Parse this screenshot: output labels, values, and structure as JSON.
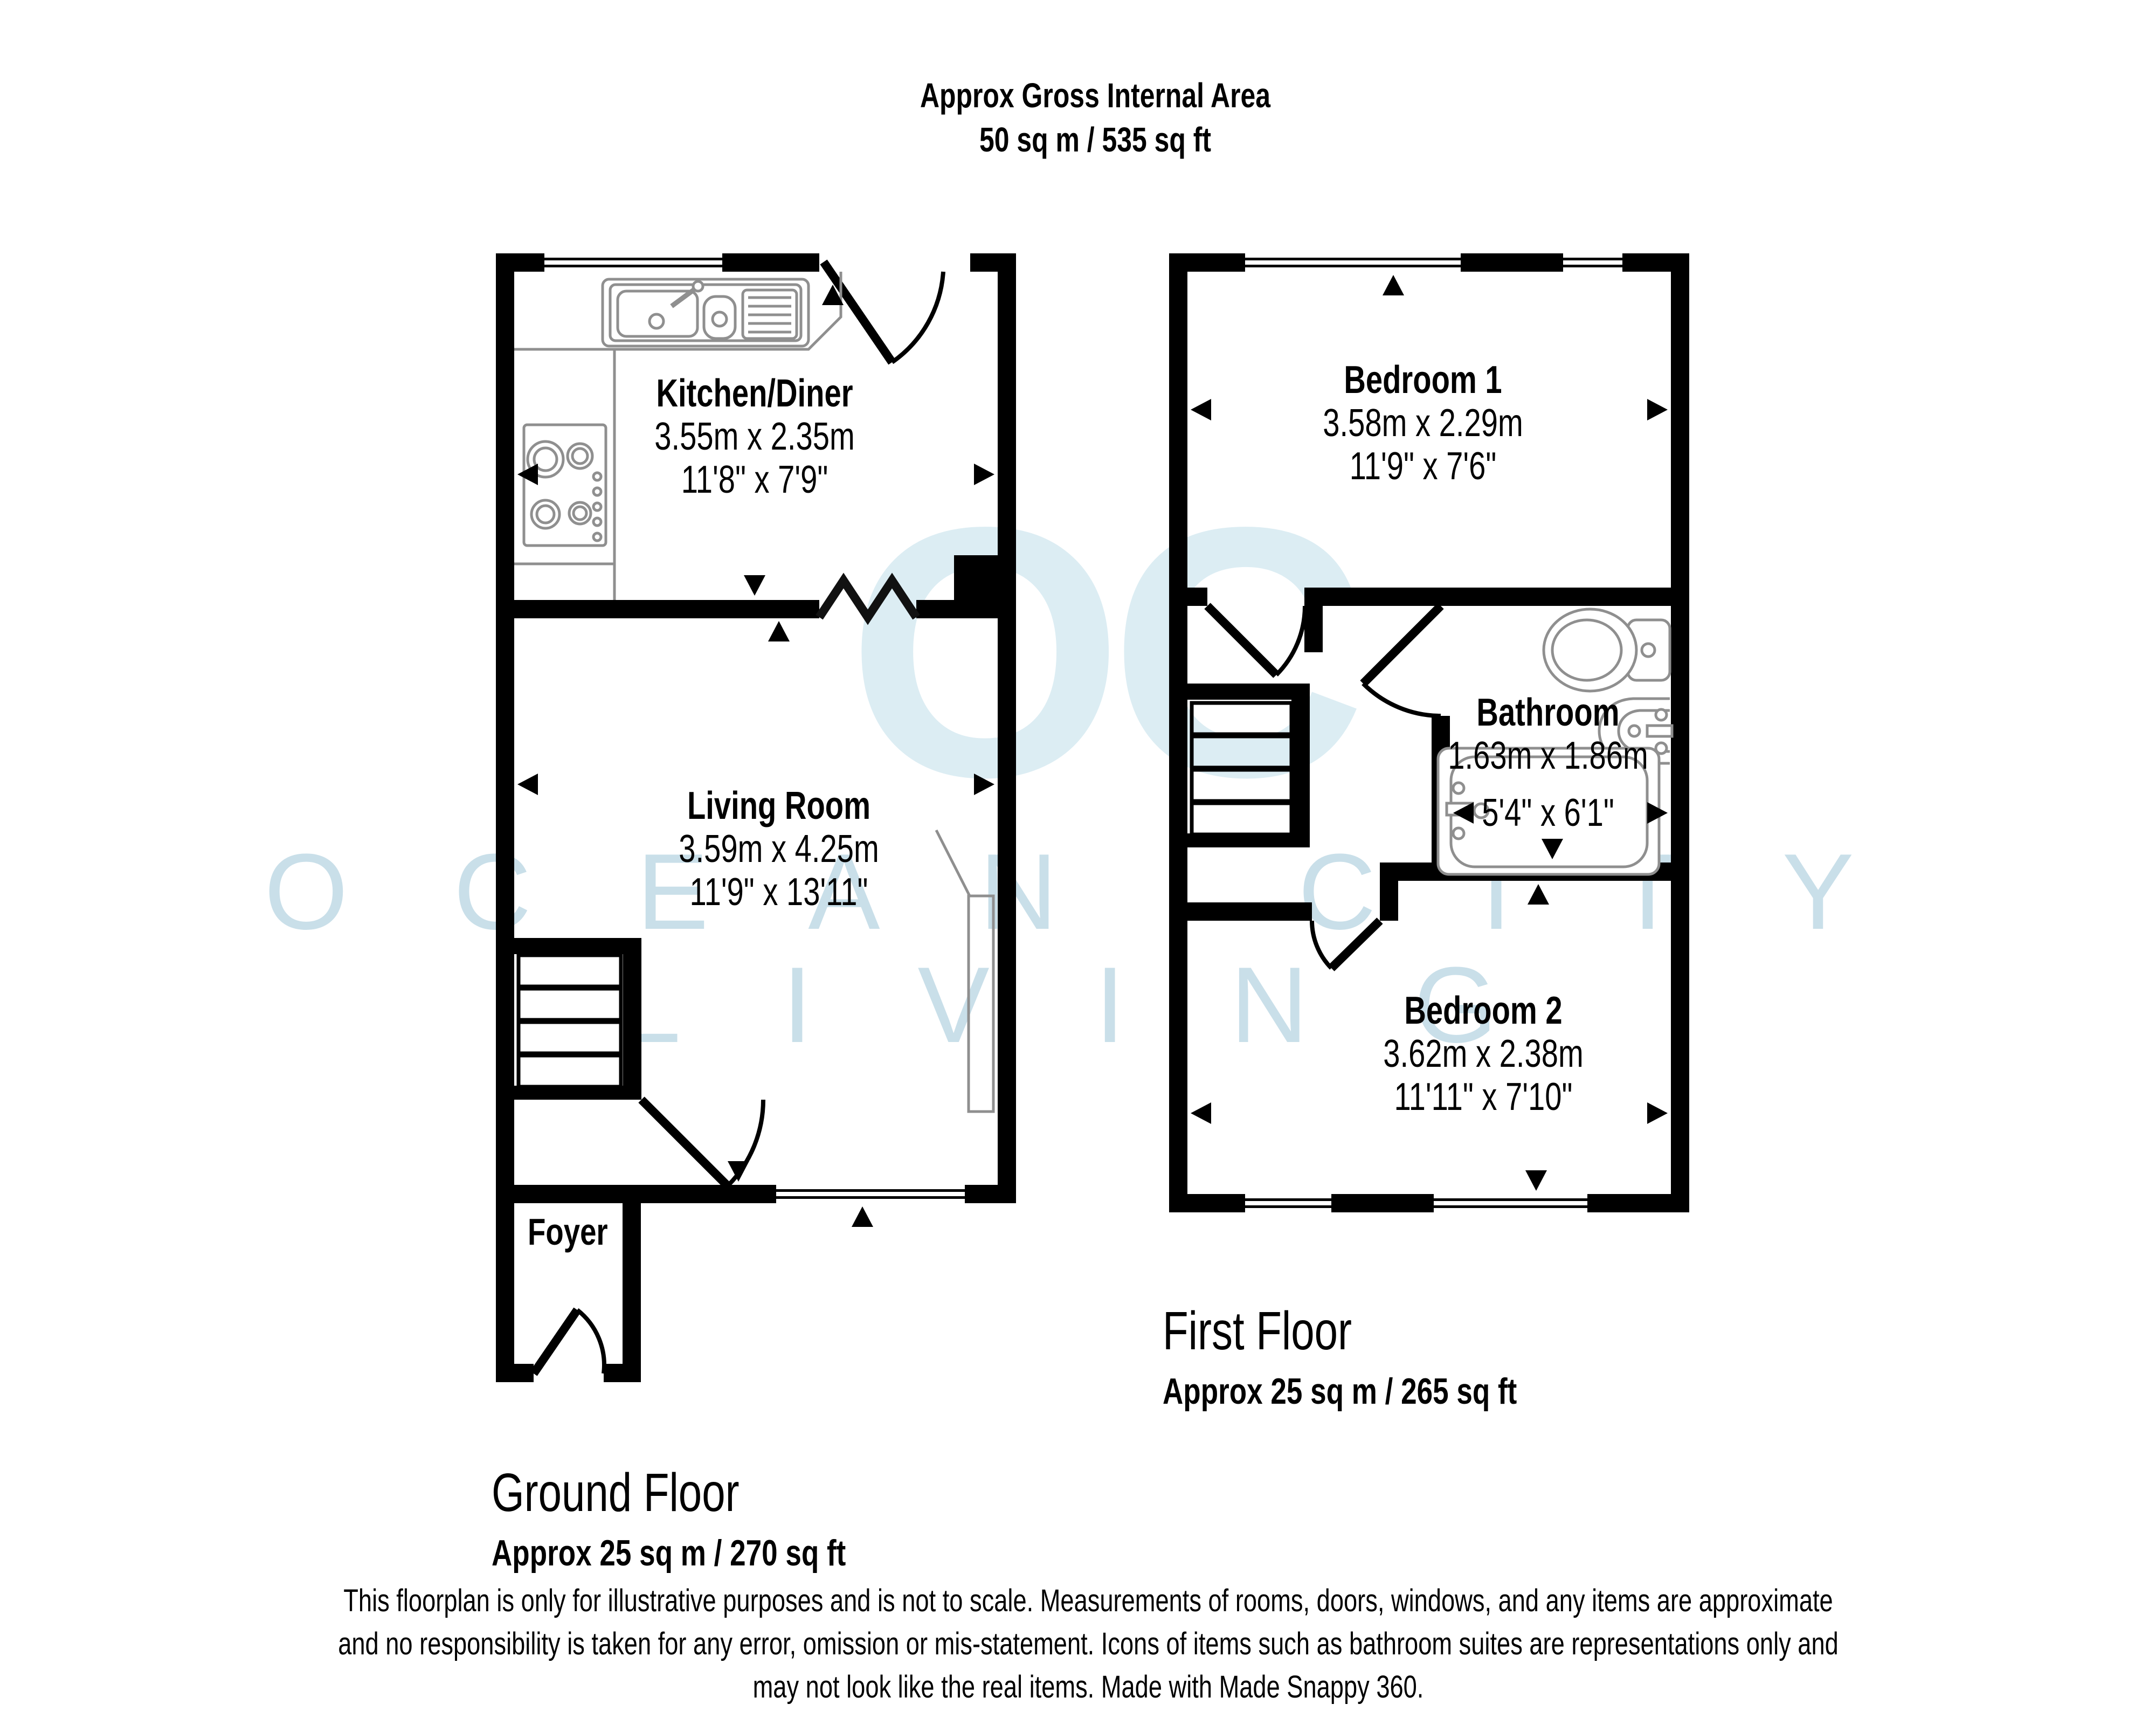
{
  "title": {
    "line1": "Approx Gross Internal Area",
    "line2": "50 sq m / 535 sq ft"
  },
  "watermark": {
    "logo": "OC",
    "line1": "O C E A N   C I T Y",
    "line2": "L I V I N G",
    "logo_color": "#dcedf3",
    "text_color": "#c9dfe9"
  },
  "ground_floor": {
    "label": "Ground Floor",
    "area": "Approx 25 sq m / 270 sq ft",
    "rooms": {
      "kitchen": {
        "name": "Kitchen/Diner",
        "metric": "3.55m x 2.35m",
        "imperial": "11'8\" x 7'9\""
      },
      "living": {
        "name": "Living Room",
        "metric": "3.59m x 4.25m",
        "imperial": "11'9\" x 13'11\""
      },
      "foyer": {
        "name": "Foyer"
      }
    }
  },
  "first_floor": {
    "label": "First Floor",
    "area": "Approx 25 sq m / 265 sq ft",
    "rooms": {
      "bedroom1": {
        "name": "Bedroom 1",
        "metric": "3.58m x 2.29m",
        "imperial": "11'9\" x 7'6\""
      },
      "bathroom": {
        "name": "Bathroom",
        "metric": "1.63m x 1.86m",
        "imperial": "5'4\" x 6'1\""
      },
      "bedroom2": {
        "name": "Bedroom 2",
        "metric": "3.62m x 2.38m",
        "imperial": "11'11\" x 7'10\""
      }
    }
  },
  "footer": {
    "line1": "This floorplan is only for illustrative purposes and is not to scale. Measurements of rooms, doors, windows, and any items are approximate",
    "line2": "and no responsibility is taken for any error, omission or mis-statement. Icons of items such as bathroom suites are representations only and",
    "line3": "may not look like the real items. Made with Made Snappy 360."
  },
  "colors": {
    "wall": "#000000",
    "fixture_outline": "#8f8f8f",
    "text": "#000000",
    "background": "#ffffff"
  },
  "icons": [
    "kitchen-sink-icon",
    "hob-icon",
    "toilet-icon",
    "basin-icon",
    "bathtub-icon",
    "stairs-icon",
    "door-swing-icon",
    "folding-door-icon",
    "window-icon",
    "measure-arrow-icon"
  ]
}
